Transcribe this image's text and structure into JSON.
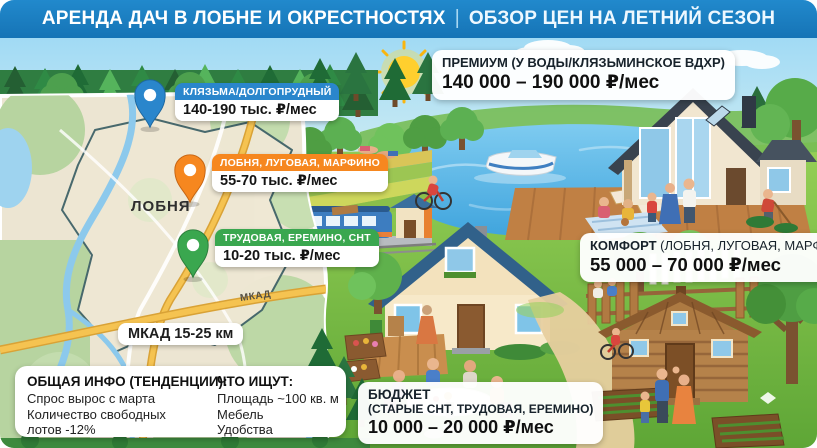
{
  "header": {
    "left": "АРЕНДА ДАЧ В ЛОБНЕ И ОКРЕСТНОСТЯХ",
    "divider": "|",
    "right": "ОБЗОР ЦЕН НА ЛЕТНИЙ СЕЗОН"
  },
  "map": {
    "city": "ЛОБНЯ",
    "road": "МКАД",
    "distance": "МКАД 15-25 км",
    "pins": {
      "klyazma": {
        "title": "КЛЯЗЬМА/ДОЛГОПРУДНЫЙ",
        "price": "140-190 тыс. ₽/мес",
        "color": "#2a86cc"
      },
      "lobnya": {
        "title": "ЛОБНЯ, ЛУГОВАЯ, МАРФИНО",
        "price": "55-70 тыс. ₽/мес",
        "color": "#f6871f"
      },
      "trudovaya": {
        "title": "ТРУДОВАЯ, ЕРЕМИНО, СНТ",
        "price": "10-20 тыс. ₽/мес",
        "color": "#3aa74f"
      }
    }
  },
  "tiers": {
    "premium": {
      "label": "ПРЕМИУМ (У ВОДЫ/КЛЯЗЬМИНСКОЕ ВДХР)",
      "price": "140 000 – 190 000 ₽/мес"
    },
    "comfort": {
      "label_bold": "КОМФОРТ",
      "label_rest": " (ЛОБНЯ, ЛУГОВАЯ, МАРФИНО)",
      "price": "55 000 – 70 000 ₽/мес"
    },
    "budget": {
      "label_bold": "БЮДЖЕТ",
      "label_rest": "(СТАРЫЕ СНТ, ТРУДОВАЯ, ЕРЕМИНО)",
      "price": "10 000 – 20 000 ₽/мес"
    }
  },
  "info": {
    "left": {
      "title": "ОБЩАЯ ИНФО (ТЕНДЕНЦИИ):",
      "lines": [
        "Спрос вырос с марта",
        "Количество свободных лотов -12%"
      ]
    },
    "right": {
      "title": "ЧТО ИЩУТ:",
      "lines": [
        "Площадь ~100 кв. м",
        "Мебель",
        "Удобства"
      ]
    }
  },
  "colors": {
    "header_blue": "#1b7ec5",
    "pin_blue": "#2a86cc",
    "pin_orange": "#f6871f",
    "pin_green": "#3aa74f",
    "card_bg": "#ffffff"
  }
}
